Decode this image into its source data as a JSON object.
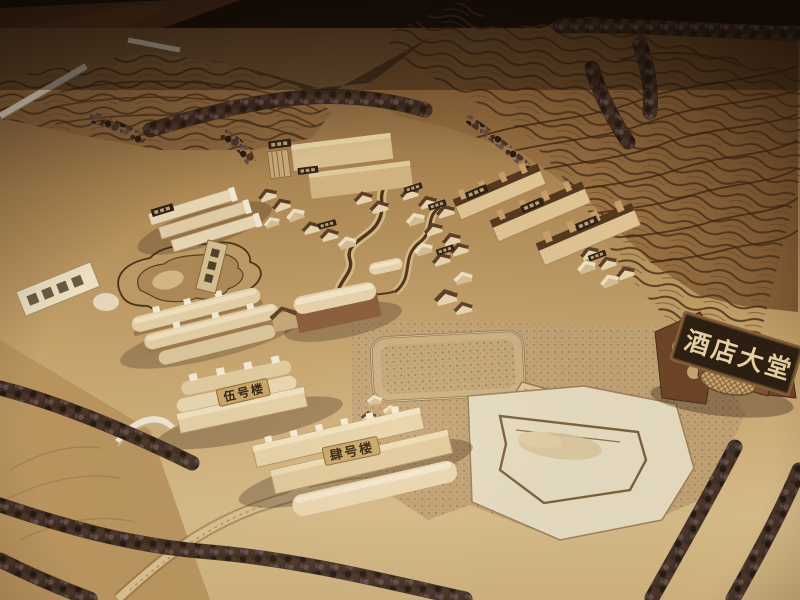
{
  "photo": {
    "signs": {
      "hotel_lobby": "酒店大堂",
      "building_5": "伍号楼",
      "building_4": "肆号楼"
    },
    "colors": {
      "room_background": "#1d120b",
      "wood_floor": "#5a3a24",
      "board_tan": "#c7a46d",
      "terrace_brown": "#8a6238",
      "contour_dark": "#4f351c",
      "building_cream": "#ecdcb8",
      "roof_dark": "#5a4029",
      "tree_dark": "#3a2a1b",
      "sign_board": "#2c1f12",
      "sign_text": "#e9d4a4",
      "label_chip": "#c9a766",
      "label_text": "#2e2010"
    }
  }
}
